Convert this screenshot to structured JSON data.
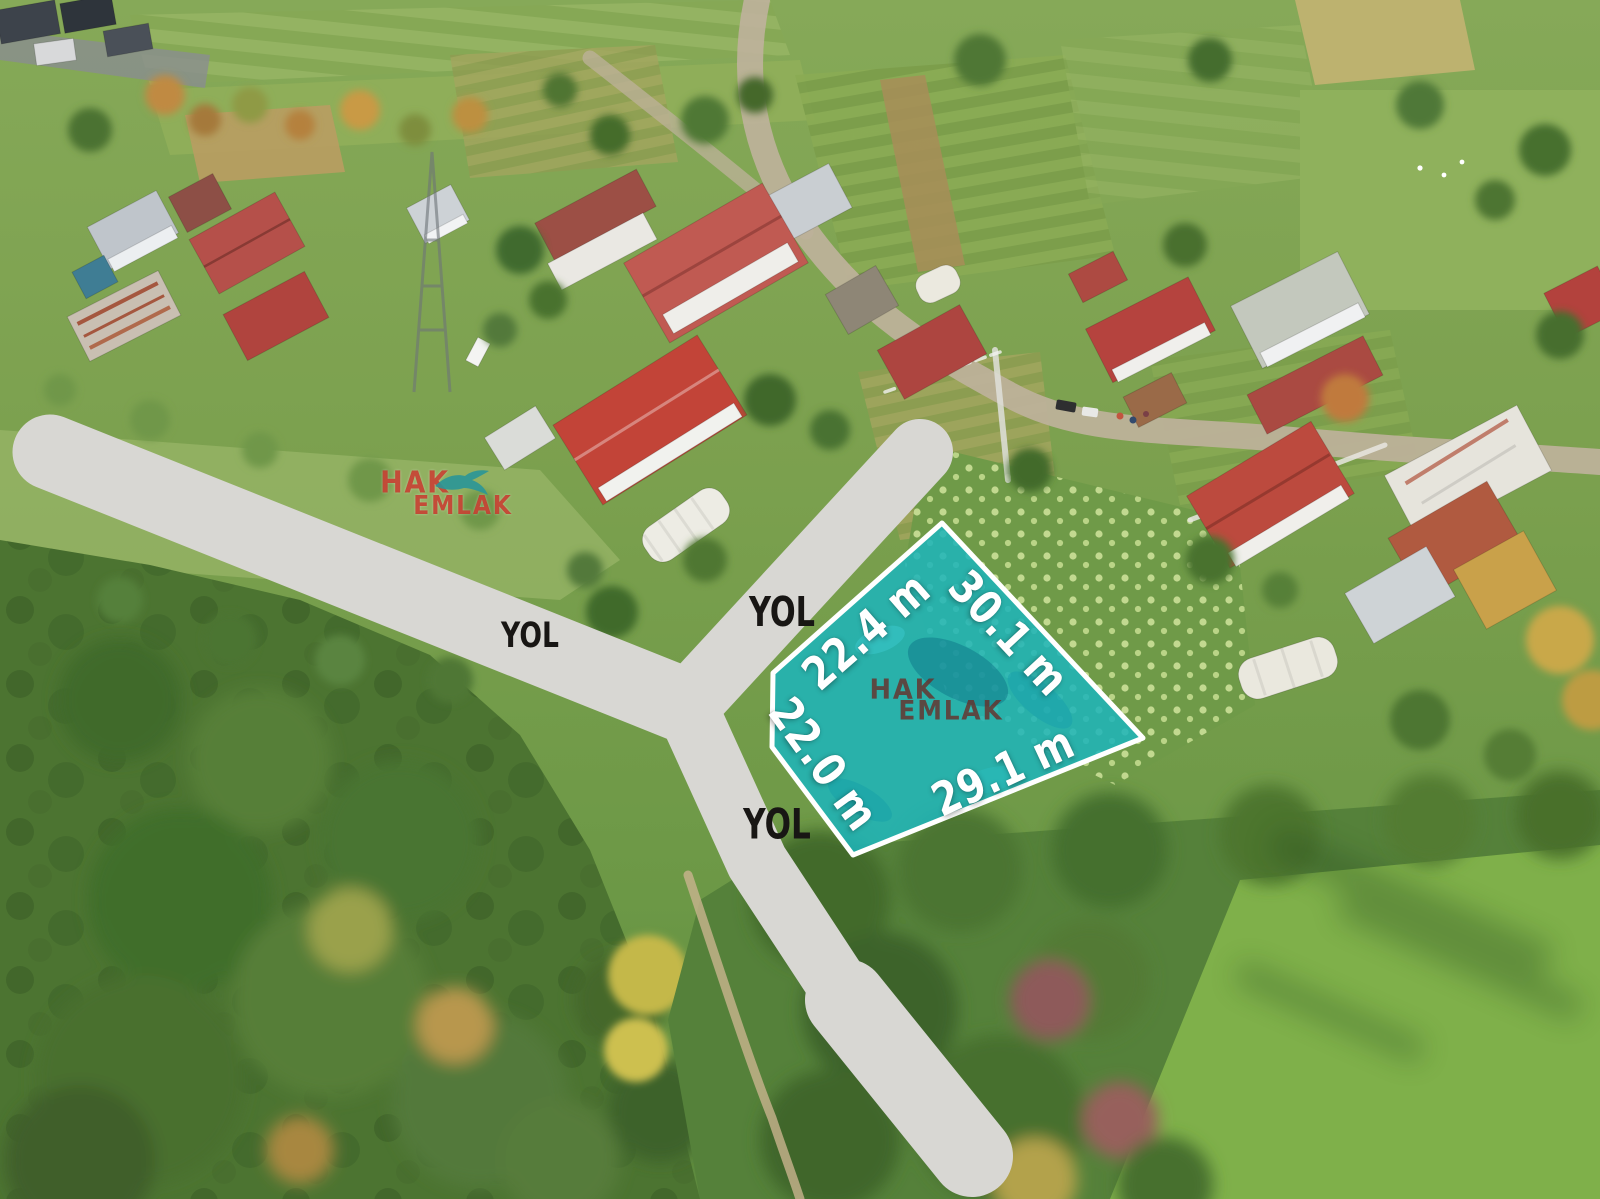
{
  "overlay": {
    "road_labels": [
      {
        "position": "upper-left-road",
        "text": "YOL"
      },
      {
        "position": "upper-right-road",
        "text": "YOL"
      },
      {
        "position": "bottom-road",
        "text": "YOL"
      }
    ],
    "parcel": {
      "measurements": [
        {
          "edge": "top-left",
          "text": "22.4 m"
        },
        {
          "edge": "top-right",
          "text": "30.1 m"
        },
        {
          "edge": "bottom-left",
          "text": "22.0 m"
        },
        {
          "edge": "bottom-right",
          "text": "29.1 m"
        }
      ],
      "fill_color": "#1db4ba",
      "border_color": "#ffffff"
    },
    "watermarks": {
      "brand_line1": "HAK",
      "brand_line2": "EMLAK",
      "bird_icon": "swallow-bird-icon",
      "corner_text_color": "#c53a2b",
      "corner_bird_color": "#2a9698",
      "center_text_color": "#682e28"
    },
    "colors": {
      "road_overlay": "#d8d7d3",
      "road_label_text": "#181614",
      "measurement_text": "#ffffff"
    }
  }
}
